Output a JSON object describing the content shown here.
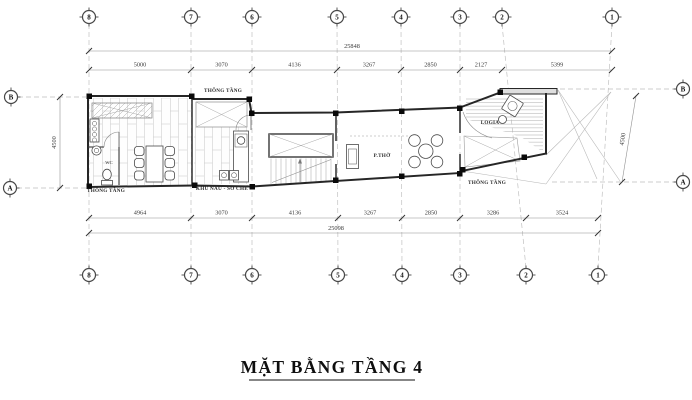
{
  "title": "MẶT BẰNG TẦNG 4",
  "grid_bubbles": {
    "top": [
      "8",
      "7",
      "6",
      "5",
      "4",
      "3",
      "2",
      "1"
    ],
    "bottom": [
      "8",
      "7",
      "6",
      "5",
      "4",
      "3",
      "2",
      "1"
    ],
    "left": [
      "B",
      "A"
    ],
    "right": [
      "B",
      "A"
    ]
  },
  "dimensions": {
    "top_overall": "25848",
    "top_segments": [
      "5000",
      "3070",
      "4136",
      "3267",
      "2850",
      "2127",
      "5399"
    ],
    "bottom_segments": [
      "4964",
      "3070",
      "4136",
      "3267",
      "2850",
      "3286",
      "3524"
    ],
    "bottom_overall": "25098",
    "left_span": "4500",
    "right_span": "4500"
  },
  "labels": {
    "void_top": "THÔNG TẦNG",
    "void_bottom_left": "THÔNG TẦNG",
    "void_right": "THÔNG TẦNG",
    "wc": "WC",
    "kitchen": "KHU NẤU - SƠ CHẾ",
    "altar_room": "P.THỜ",
    "loggia": "LOGIA"
  },
  "colors": {
    "paper": "#ffffff",
    "wall": "#262626",
    "dim_line": "#909090",
    "grid_dash": "#bcbcbc",
    "floor_joint": "#cfcfcf",
    "text": "#2b2b2b"
  }
}
